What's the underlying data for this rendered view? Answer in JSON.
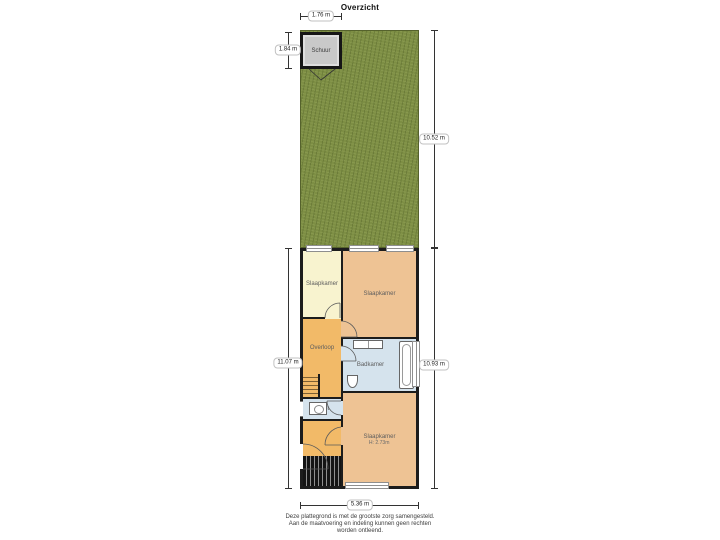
{
  "title": "Overzicht",
  "garden": {
    "shed_label": "Schuur"
  },
  "rooms": {
    "bedroom_top_left": {
      "label": "Slaapkamer"
    },
    "bedroom_top_right": {
      "label": "Slaapkamer"
    },
    "landing": {
      "label": "Overloop"
    },
    "bathroom": {
      "label": "Badkamer"
    },
    "toilet": {
      "label": "Toilet"
    },
    "bedroom_bottom": {
      "label": "Slaapkamer",
      "height_note": "H: 2.73m"
    }
  },
  "dimensions": {
    "shed_width": "1.76 m",
    "shed_depth": "1.84 m",
    "garden_depth": "10.52 m",
    "house_depth_left": "11.07 m",
    "house_depth_right": "10.93 m",
    "house_width": "5.36 m"
  },
  "footer": {
    "line1": "Deze plattegrond is met de grootste zorg samengesteld.",
    "line2": "Aan de maatvoering en indeling kunnen geen rechten",
    "line3": "worden ontleend."
  },
  "colors": {
    "wall_black": "#1c1c1c",
    "garden_green": "#7d8e44",
    "shed_gray": "#c9c9c9",
    "bedroom_tan": "#eec394",
    "bedroom_yellow": "#f8f3cf",
    "hallway_orange": "#f2ba68",
    "bathroom_blue": "#d5e3ed"
  }
}
